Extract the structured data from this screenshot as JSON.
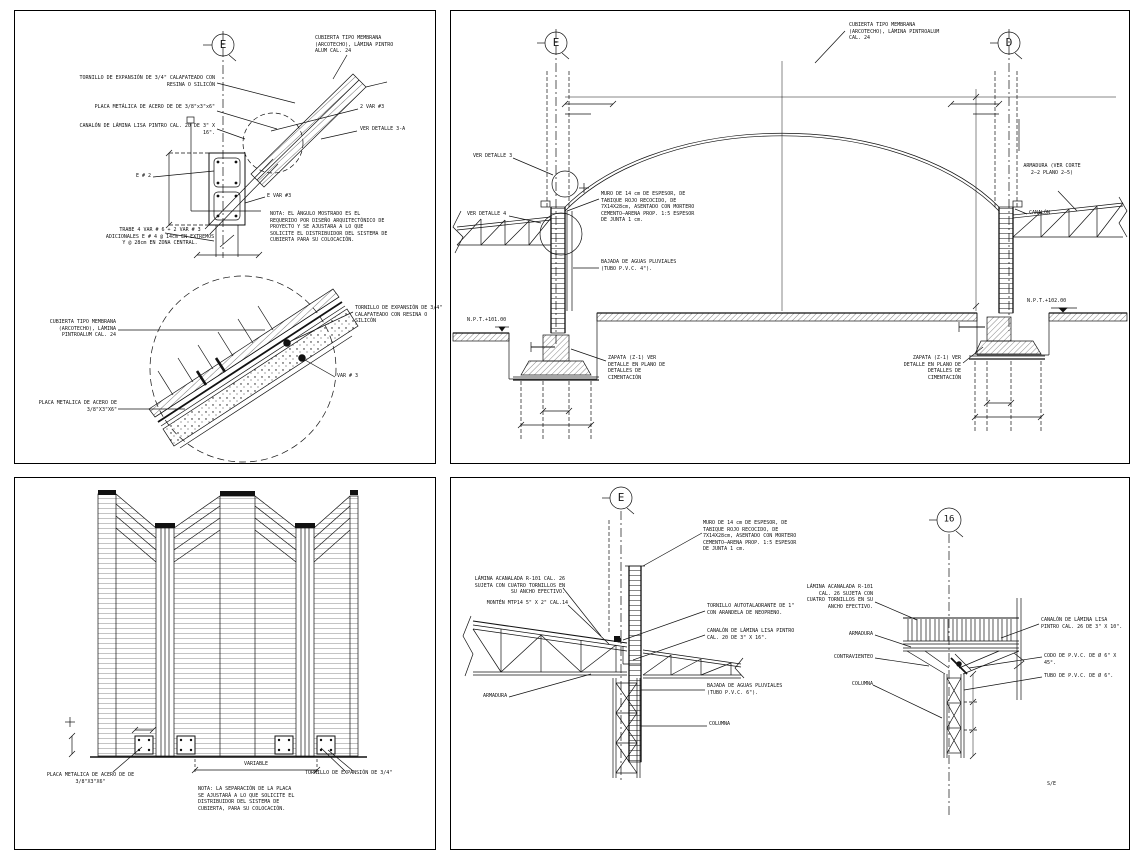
{
  "sheet": {
    "scale_note": "S/E",
    "line_color": "#111111",
    "background": "#ffffff"
  },
  "detail_e": {
    "bubble": "E",
    "cubierta": "CUBIERTA TIPO MEMBRANA (ARCOTECHO), LÁMINA PINTRO ALUM CAL. 24",
    "tornillo": "TORNILLO DE EXPANSIÓN DE 3/4\" CALAFATEADO CON RESINA O SILICÓN",
    "placa": "PLACA METÁLICA DE ACERO DE DE 3/8\"x3\"x6\"",
    "canalon": "CANALÓN DE LÁMINA LISA PINTRO CAL. 20 DE 3\" X 16\".",
    "var2": "2 VAR #3",
    "ver_detalle_3a": "VER DETALLE 3-A",
    "estribo": "E # 2",
    "evar": "E VAR #3",
    "trabe": "TRABE 4 VAR # 6 + 2 VAR # 3 ADICIONALES E # 4 @ 14cm EN EXTREMOS Y @ 28cm EN ZONA CENTRAL.",
    "nota": "NOTA: EL ÁNGULO MOSTRADO ES EL REQUERIDO POR DISEÑO ARQUITECTÓNICO DE PROYECTO Y SE AJUSTARA A LO QUE SOLICITE EL DISTRIBUIDOR DEL SISTEMA DE CUBIERTA PARA SU COLOCACIÓN."
  },
  "detail_3a": {
    "cubierta": "CUBIERTA TIPO MEMBRANA (ARCOTECHO), LÁMINA PINTROALUM CAL. 24",
    "tornillo": "TORNILLO DE EXPANSIÓN DE 3/4\" CALAFATEADO CON RESINA O SILICÓN",
    "var3": "VAR # 3",
    "placa": "PLACA METALICA DE ACERO DE 3/8\"X3\"X6\""
  },
  "section": {
    "bubble_left": "E",
    "bubble_right": "D",
    "cubierta": "CUBIERTA TIPO MEMBRANA (ARCOTECHO), LÁMINA PINTROALUM CAL. 24",
    "ver_detalle_3": "VER DETALLE 3",
    "ver_detalle_4": "VER DETALLE 4",
    "muro": "MURO DE 14 cm DE ESPESOR, DE TABIQUE ROJO RECOCIDO, DE 7X14X28cm, ASENTADO CON MORTERO CEMENTO–ARENA PROP. 1:5 ESPESOR DE JUNTA 1 cm.",
    "bajada": "BAJADA DE AGUAS PLUVIALES (TUBO P.V.C. 4\").",
    "npt_left": "N.P.T.+101.00",
    "npt_right": "N.P.T.+102.00",
    "zapata": "ZAPATA (Z-1) VER DETALLE EN PLANO DE DETALLES DE CIMENTACIÓN",
    "armadura": "ARMADURA (VER CORTE 2–2 PLANO 2–5)",
    "canalon": "CANALÓN"
  },
  "elevation": {
    "placa": "PLACA METALICA DE ACERO DE DE 3/8\"X3\"X6\"",
    "variable": "VARIABLE",
    "tornillo": "TORNILLO DE EXPANSIÓN DE 3/4\"",
    "nota": "NOTA: LA SEPARACIÓN DE LA PLACA SE AJUSTARÁ A LO QUE SOLICITE EL DISTRIBUIDOR DEL SISTEMA DE CUBIERTA, PARA SU COLOCACIÓN."
  },
  "details2": {
    "bubble_left": "E",
    "bubble_right": "16",
    "muro": "MURO DE 14 cm DE ESPESOR, DE TABIQUE ROJO RECOCIDO, DE 7X14X28cm, ASENTADO CON MORTERO CEMENTO–ARENA PROP. 1:5 ESPESOR DE JUNTA 1 cm.",
    "lamina": "LÁMINA ACANALADA R-101 CAL. 26 SUJETA CON CUATRO TORNILLOS EN SU ANCHO EFECTIVO.",
    "monten": "MONTÉN MTP14 5\" X 2\" CAL.14",
    "armadura": "ARMADURA",
    "tornillo_auto": "TORNILLO AUTOTALADRANTE DE 1\" CON ARANDELA DE NEOPRENO.",
    "canalon": "CANALÓN DE LÁMINA LISA PINTRO CAL. 20 DE 3\" X 16\".",
    "bajada": "BAJADA DE AGUAS PLUVIALES (TUBO P.V.C. 6\").",
    "columna": "COLUMNA",
    "lamina_r": "LÁMINA ACANALADA R-101 CAL. 26 SUJETA CON CUATRO TORNILLOS EN SU ANCHO EFECTIVO.",
    "armadura_r": "ARMADURA",
    "contraviento": "CONTRAVIENTEO",
    "columna_r": "COLUMNA",
    "canalon_r": "CANALÓN DE LÁMINA LISA PINTRO CAL. 26 DE 3\" X 10\".",
    "codo": "CODO DE P.V.C. DE Ø 6\" X 45°.",
    "tubo": "TUBO DE P.V.C. DE Ø 6\"."
  }
}
